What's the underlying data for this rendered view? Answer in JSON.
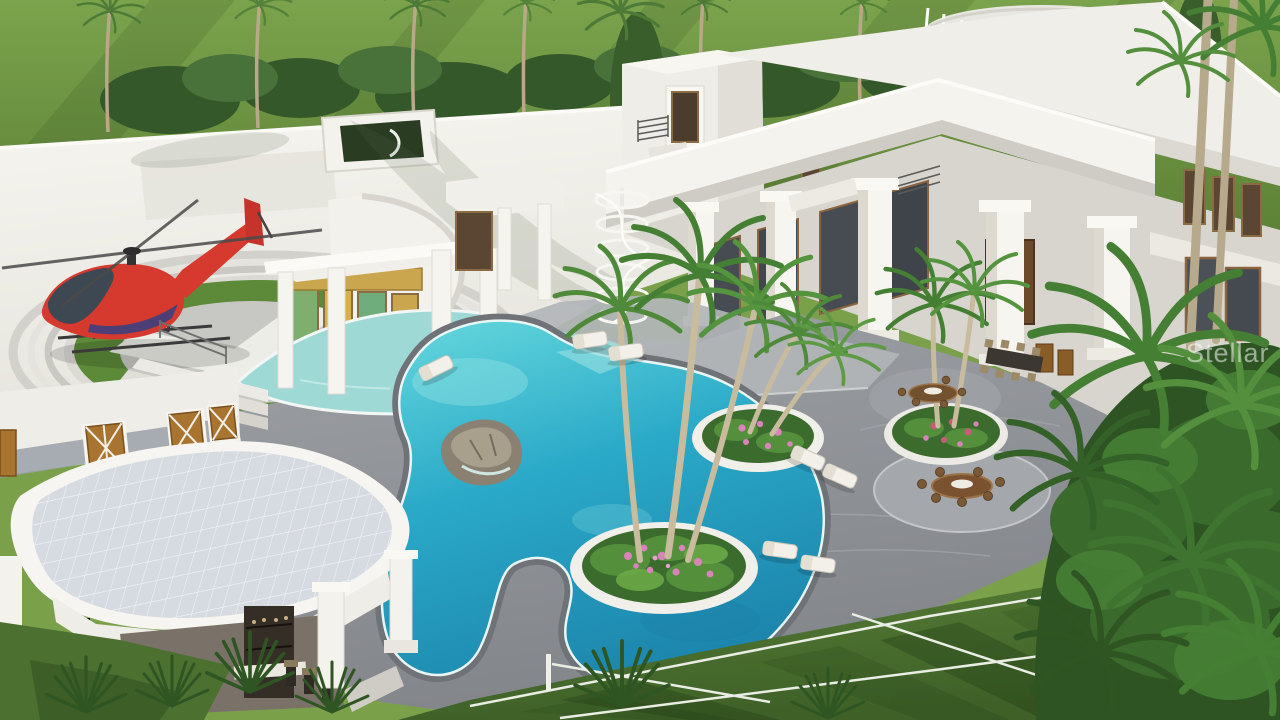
{
  "image": {
    "type": "3d-architectural-rendering",
    "description": "Aerial rendering of a white luxury estate: helipad with red helicopter on the left roof, grand columned entry with stained glass, freeform turquoise pool with flower islands and palms, gray paver terraces with dining sets and loungers, colonnaded right wing, pool cabana with tiled roof, grass tennis court and tropical landscaping",
    "watermark": "Stellar MLS"
  },
  "palette": {
    "lawn_green": "#6b8f3f",
    "court_green": "#4c7030",
    "patio_gray": "#8f9297",
    "building_white": "#f2f0ea",
    "pool_turquoise": "#2fb3cc",
    "water_feature": "#9ed9d6",
    "roof_tile": "#d5dbe1",
    "helipad_green": "#5d8a39",
    "helicopter_red": "#d63a2e",
    "flower_pink": "#d983bb",
    "foliage_green": "#3f7330",
    "trunk_tan": "#c0b194",
    "wood_brown": "#8a6340",
    "glass_dark": "#4a5056",
    "watermark": "#ffffff"
  },
  "scene": {
    "elements": [
      "background-lawn",
      "tree-line",
      "left-roof-wing",
      "rooftop-atrium",
      "helipad",
      "helicopter",
      "entry-rotunda",
      "entry-portico",
      "entry-steps",
      "water-feature-moat",
      "dining-platform",
      "spiral-staircase",
      "middle-tower",
      "rooftop-balustrade",
      "right-wing",
      "colonnade",
      "main-pool",
      "rock-waterfall",
      "planter-islands",
      "palm-clusters",
      "dining-sets",
      "lounge-chairs",
      "tennis-court",
      "net-posts",
      "pool-cabana",
      "cabana-bar",
      "tropical-foliage",
      "watermark"
    ]
  }
}
